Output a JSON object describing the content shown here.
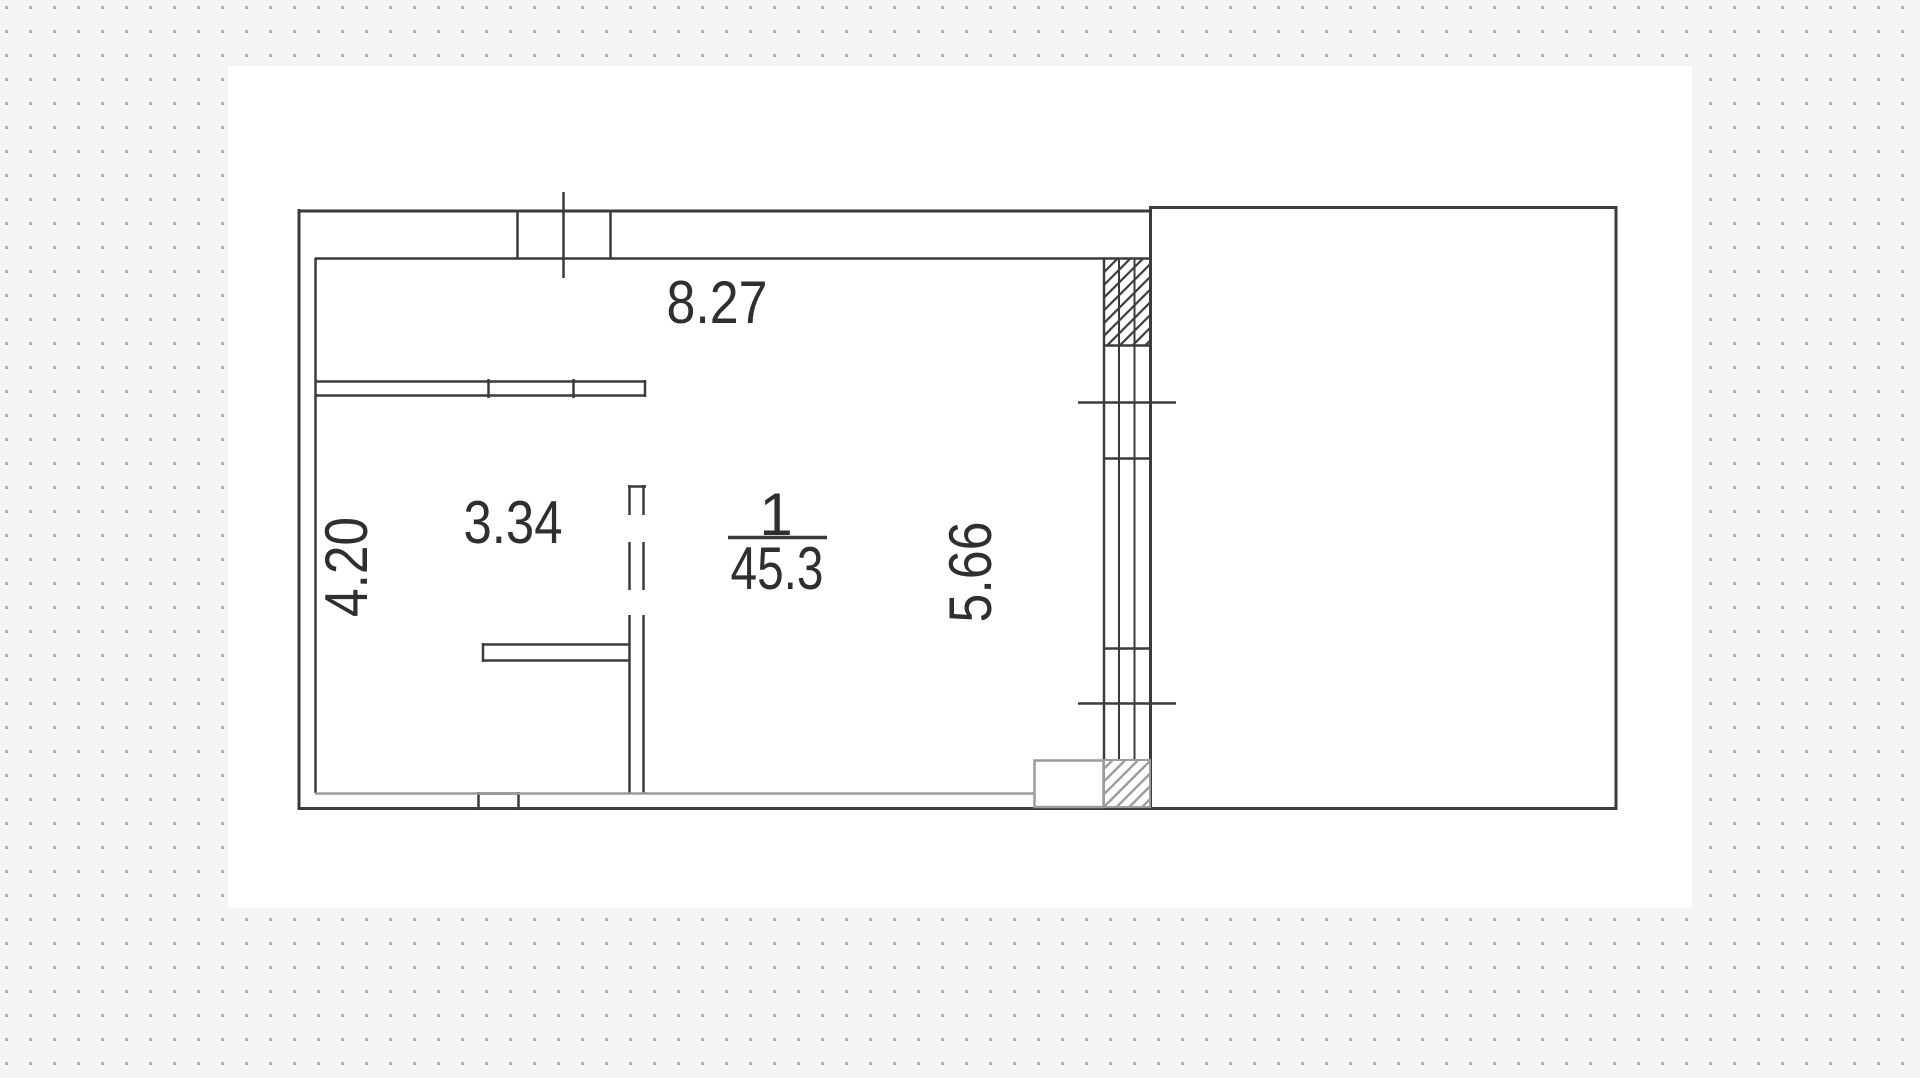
{
  "plan": {
    "room": {
      "number": "1",
      "area": "45.3"
    },
    "dimensions": {
      "top_wall_width": "8.27",
      "inner_room_width": "3.34",
      "left_wall_height": "4.20",
      "right_wall_height": "5.66"
    }
  },
  "colors": {
    "background": "#f5f5f5",
    "sheet": "#ffffff",
    "dots": "#b0b0b0",
    "line_dark": "#3b3b3b",
    "line_gray": "#9c9c9c",
    "text": "#2f2f2f"
  }
}
